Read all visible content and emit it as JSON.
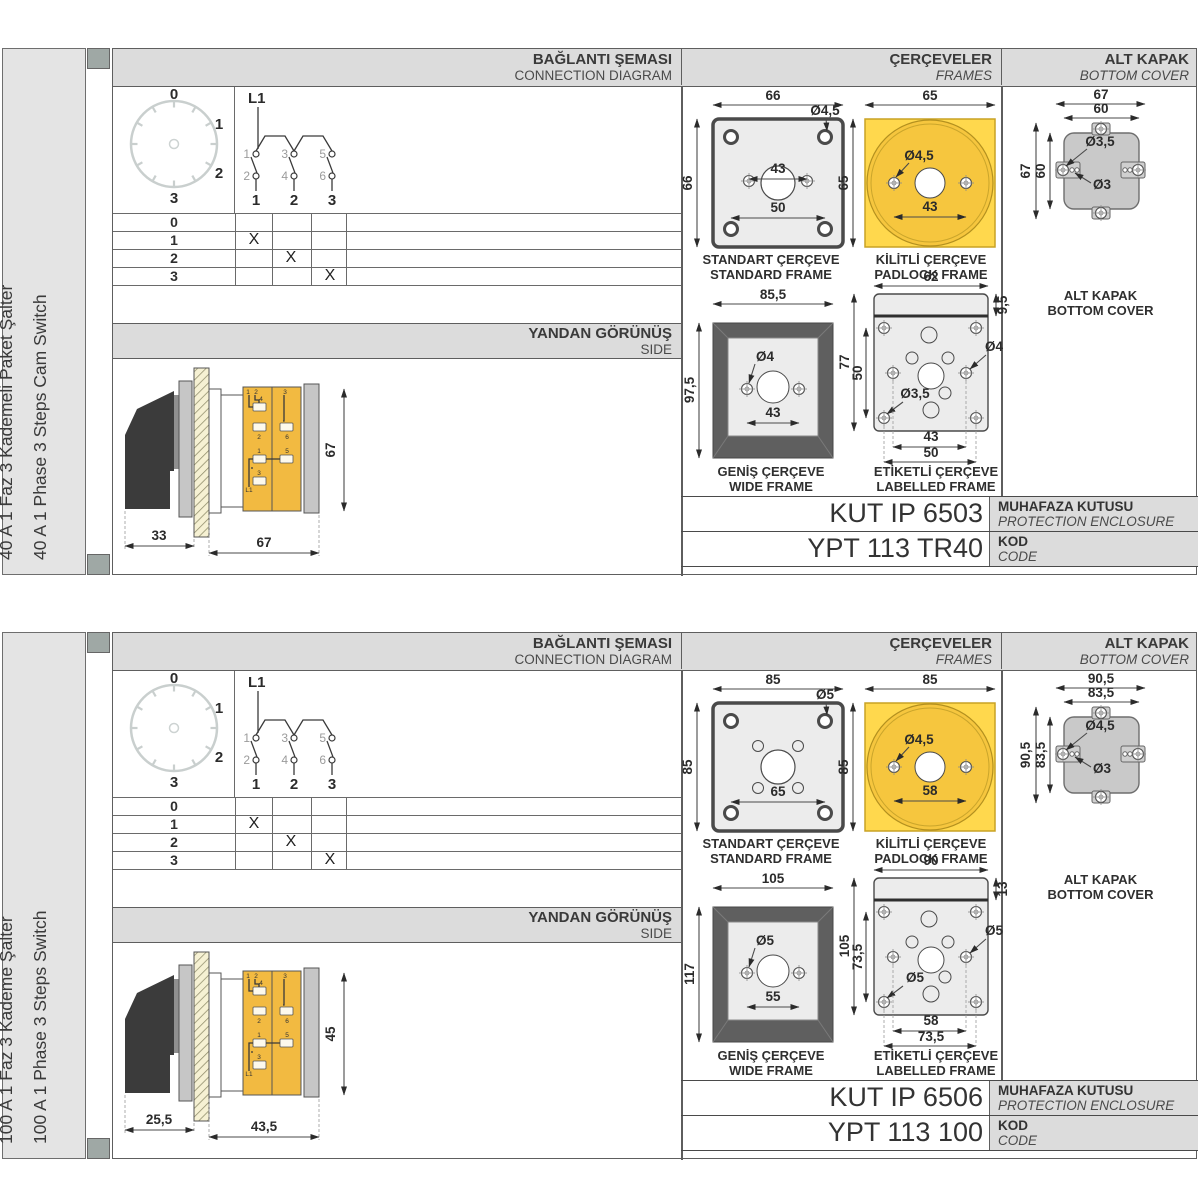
{
  "colors": {
    "header_bg": "#dcdcdc",
    "label_col_bg": "#e4e4e4",
    "frame_yellow": "#ffd84d",
    "frame_yellow_circle": "#f6c63e",
    "body_yellow": "#f2ba41",
    "drawing_gray": "#c9c9c9",
    "frame_dark_gray": "#5f5f5f",
    "panel_light": "#ececec",
    "spine_marker_gray": "#9fa8a5"
  },
  "sections": [
    {
      "side_title_tr": "40 A 1 Faz 3 Kademeli Paket Şalter",
      "side_title_en": "40 A 1 Phase 3 Steps Cam Switch",
      "headers": {
        "diagram_tr": "BAĞLANTI ŞEMASI",
        "diagram_en": "CONNECTION DIAGRAM",
        "frames_tr": "ÇERÇEVELER",
        "frames_en": "FRAMES",
        "cover_tr": "ALT KAPAK",
        "cover_en": "BOTTOM COVER",
        "side_tr": "YANDAN GÖRÜNÜŞ",
        "side_en": "SIDE"
      },
      "dial": {
        "p0": "0",
        "p1": "1",
        "p2": "2",
        "p3": "3"
      },
      "circuit": {
        "phase": "L1",
        "t1": "1",
        "t2": "3",
        "t3": "5",
        "b1": "2",
        "b2": "4",
        "b3": "6",
        "o1": "1",
        "o2": "2",
        "o3": "3"
      },
      "table": {
        "r0": "0",
        "r1": "1",
        "r2": "2",
        "r3": "3",
        "m1": "X",
        "m2": "X",
        "m3": "X"
      },
      "side_view": {
        "dim_knob": "33",
        "dim_length": "67",
        "dim_height": "67"
      },
      "standard_frame": {
        "title_tr": "STANDART ÇERÇEVE",
        "title_en": "STANDARD FRAME",
        "dim_width": "66",
        "dim_height": "66",
        "hole_dia": "Ø4,5",
        "dim_mid": "43",
        "dim_bottom": "50"
      },
      "padlock_frame": {
        "title_tr": "KİLİTLİ ÇERÇEVE",
        "title_en": "PADLOCK FRAME",
        "dim_width": "65",
        "dim_height": "65",
        "hole_dia": "Ø4,5",
        "dim_mid": "43"
      },
      "wide_frame": {
        "title_tr": "GENİŞ ÇERÇEVE",
        "title_en": "WIDE FRAME",
        "dim_width": "85,5",
        "dim_height": "97,5",
        "hole_dia": "Ø4",
        "dim_mid": "43"
      },
      "labelled_frame": {
        "title_tr": "ETİKETLİ ÇERÇEVE",
        "title_en": "LABELLED FRAME",
        "dim_width": "62",
        "dim_strip": "9,5",
        "dim_height": "77",
        "dim_inner_height": "50",
        "hole_dia_right": "Ø4",
        "hole_dia_left": "Ø3,5",
        "dim_inner": "43",
        "dim_outer": "50"
      },
      "bottom_cover": {
        "title_tr": "ALT KAPAK",
        "title_en": "BOTTOM COVER",
        "dim_width_outer": "67",
        "dim_width_inner": "60",
        "dim_height_outer": "67",
        "dim_height_inner": "60",
        "hole_dia_tab": "Ø3,5",
        "hole_dia_small": "Ø3"
      },
      "codes": {
        "enclosure_value": "KUT IP 6503",
        "enclosure_label_tr": "MUHAFAZA KUTUSU",
        "enclosure_label_en": "PROTECTION ENCLOSURE",
        "code_value": "YPT 113 TR40",
        "code_label_tr": "KOD",
        "code_label_en": "CODE"
      }
    },
    {
      "side_title_tr": "100 A 1 Faz 3 Kademe Şalter",
      "side_title_en": "100 A 1 Phase 3 Steps Switch",
      "headers": {
        "diagram_tr": "BAĞLANTI ŞEMASI",
        "diagram_en": "CONNECTION DIAGRAM",
        "frames_tr": "ÇERÇEVELER",
        "frames_en": "FRAMES",
        "cover_tr": "ALT KAPAK",
        "cover_en": "BOTTOM COVER",
        "side_tr": "YANDAN GÖRÜNÜŞ",
        "side_en": "SIDE"
      },
      "dial": {
        "p0": "0",
        "p1": "1",
        "p2": "2",
        "p3": "3"
      },
      "circuit": {
        "phase": "L1",
        "t1": "1",
        "t2": "3",
        "t3": "5",
        "b1": "2",
        "b2": "4",
        "b3": "6",
        "o1": "1",
        "o2": "2",
        "o3": "3"
      },
      "table": {
        "r0": "0",
        "r1": "1",
        "r2": "2",
        "r3": "3",
        "m1": "X",
        "m2": "X",
        "m3": "X"
      },
      "side_view": {
        "dim_knob": "25,5",
        "dim_length": "43,5",
        "dim_height": "45"
      },
      "standard_frame": {
        "title_tr": "STANDART ÇERÇEVE",
        "title_en": "STANDARD FRAME",
        "dim_width": "85",
        "dim_height": "85",
        "hole_dia": "Ø5",
        "dim_bottom": "65"
      },
      "padlock_frame": {
        "title_tr": "KİLİTLİ ÇERÇEVE",
        "title_en": "PADLOCK FRAME",
        "dim_width": "85",
        "dim_height": "85",
        "hole_dia": "Ø4,5",
        "dim_mid": "58"
      },
      "wide_frame": {
        "title_tr": "GENİŞ ÇERÇEVE",
        "title_en": "WIDE FRAME",
        "dim_width": "105",
        "dim_height": "117",
        "hole_dia": "Ø5",
        "dim_mid": "55"
      },
      "labelled_frame": {
        "title_tr": "ETİKETLİ ÇERÇEVE",
        "title_en": "LABELLED FRAME",
        "dim_width": "90",
        "dim_strip": "13",
        "dim_height": "105",
        "dim_inner_height": "73,5",
        "hole_dia_right": "Ø5",
        "hole_dia_left": "Ø5",
        "dim_inner": "58",
        "dim_outer": "73,5"
      },
      "bottom_cover": {
        "title_tr": "ALT KAPAK",
        "title_en": "BOTTOM COVER",
        "dim_width_outer": "90,5",
        "dim_width_inner": "83,5",
        "dim_height_outer": "90,5",
        "dim_height_inner": "83,5",
        "hole_dia_tab": "Ø4,5",
        "hole_dia_small": "Ø3"
      },
      "codes": {
        "enclosure_value": "KUT IP 6506",
        "enclosure_label_tr": "MUHAFAZA KUTUSU",
        "enclosure_label_en": "PROTECTION ENCLOSURE",
        "code_value": "YPT 113 100",
        "code_label_tr": "KOD",
        "code_label_en": "CODE"
      }
    }
  ]
}
